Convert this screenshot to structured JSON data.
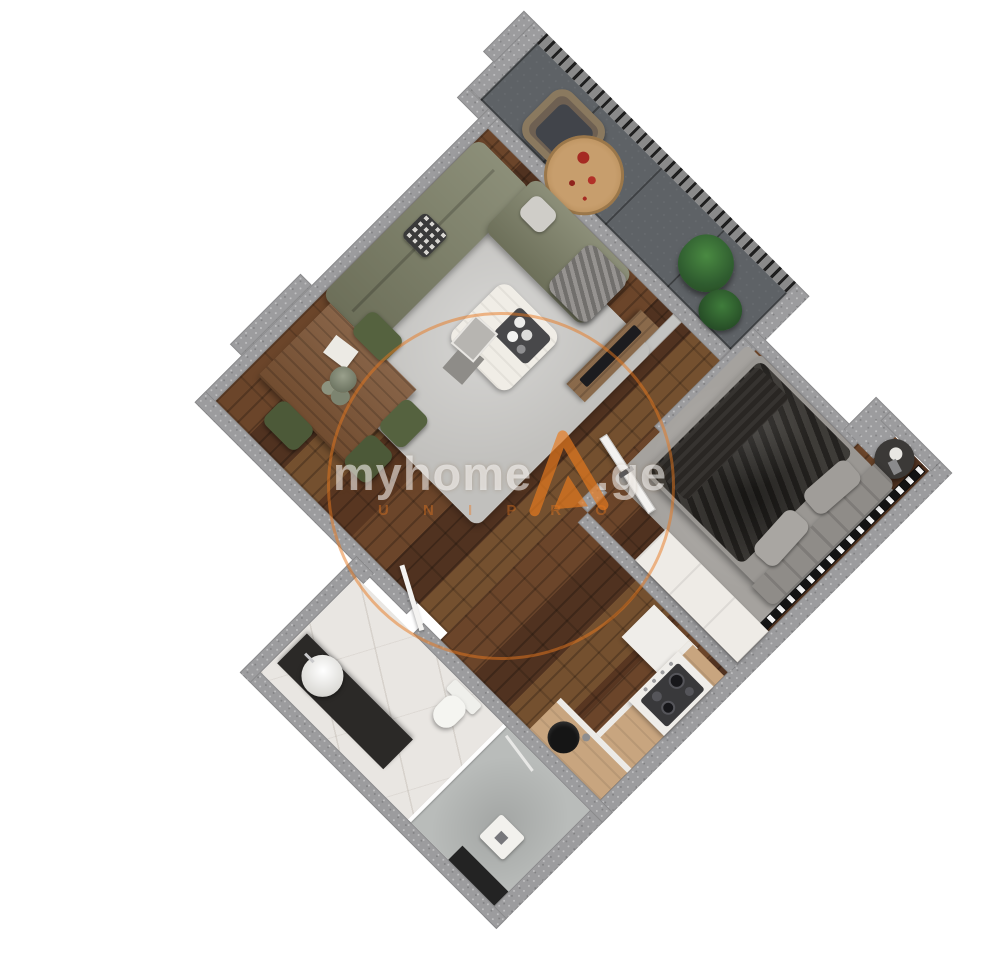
{
  "watermark": {
    "brand": "myhome",
    "tld": ".ge",
    "subtext": "U N I P R O",
    "accent_color": "#e87a1e"
  },
  "palette": {
    "wall_outer": "#9c9c9e",
    "interior_wall": "#c3c3c1",
    "wood_floor": "#5d3b26",
    "balcony_tile": "#5e6266",
    "marble_floor": "#e9e6e2",
    "living_rug": "#c1c0bd",
    "bedroom_rug": "#a5a29e",
    "sofa_olive": "#7c7f66",
    "dining_chair_green": "#55623f",
    "counter_tan": "#c8a57f",
    "duvet_charcoal": "#34312d",
    "sink_black": "#151515"
  },
  "rooms": [
    {
      "id": "balcony",
      "furniture": [
        "wicker-chair",
        "round-jute-rug",
        "potted-plants"
      ]
    },
    {
      "id": "living-dining",
      "furniture": [
        "corner-sofa",
        "coffee-table",
        "tray-with-cups",
        "magazines",
        "dining-table",
        "dining-chairs",
        "tv-console",
        "tv"
      ]
    },
    {
      "id": "bedroom",
      "furniture": [
        "double-bed",
        "headboard",
        "pillows",
        "nightstand",
        "wardrobe",
        "radiator"
      ]
    },
    {
      "id": "kitchen",
      "furniture": [
        "cooktop-counter",
        "sink-counter",
        "fridge-cabinet"
      ]
    },
    {
      "id": "bathroom",
      "furniture": [
        "vanity",
        "vessel-sink",
        "toilet",
        "shower-tray",
        "shower-glass",
        "wall-niche"
      ]
    }
  ]
}
